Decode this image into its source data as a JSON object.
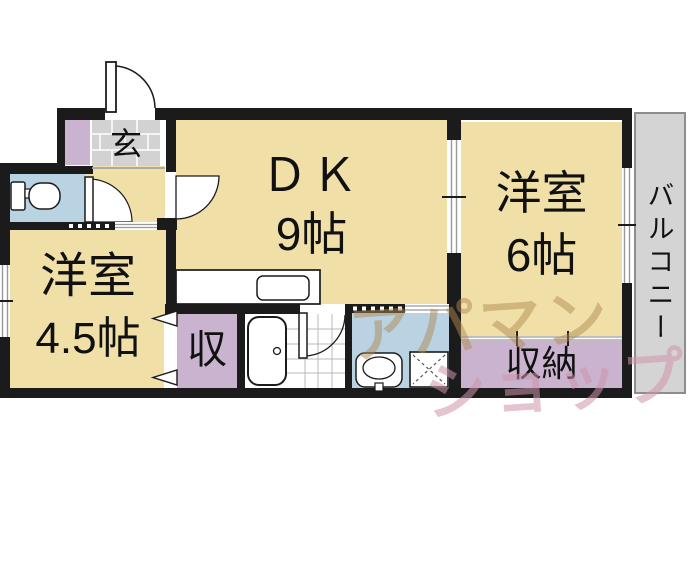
{
  "floorplan": {
    "rooms": {
      "genkan": {
        "label": "玄"
      },
      "dk": {
        "label": "ＤＫ",
        "size": "9帖"
      },
      "western6": {
        "label": "洋室",
        "size": "6帖"
      },
      "western45": {
        "label": "洋室",
        "size": "4.5帖"
      },
      "closetSmall": {
        "label": "収"
      },
      "closet": {
        "label": "収納"
      },
      "balcony": {
        "label": "バルコニー"
      }
    },
    "watermark": {
      "line1": "アパマン",
      "line2": "ショップ"
    },
    "fixtures": [
      "entrance-door-icon",
      "toilet-icon",
      "bathtub-icon",
      "wash-basin-icon",
      "washer-pan-icon",
      "kitchen-counter-icon",
      "kitchen-sink-icon"
    ],
    "colors": {
      "floor": "#f0e0a8",
      "wet_room": "#b9d3e3",
      "closet": "#cab3ce",
      "genkan_tile": "#d2d2d2",
      "balcony": "#d4d4d4",
      "wall": "#1b1b1b",
      "watermark_top": "#b08a52",
      "watermark_bottom": "#ce94aa"
    }
  }
}
